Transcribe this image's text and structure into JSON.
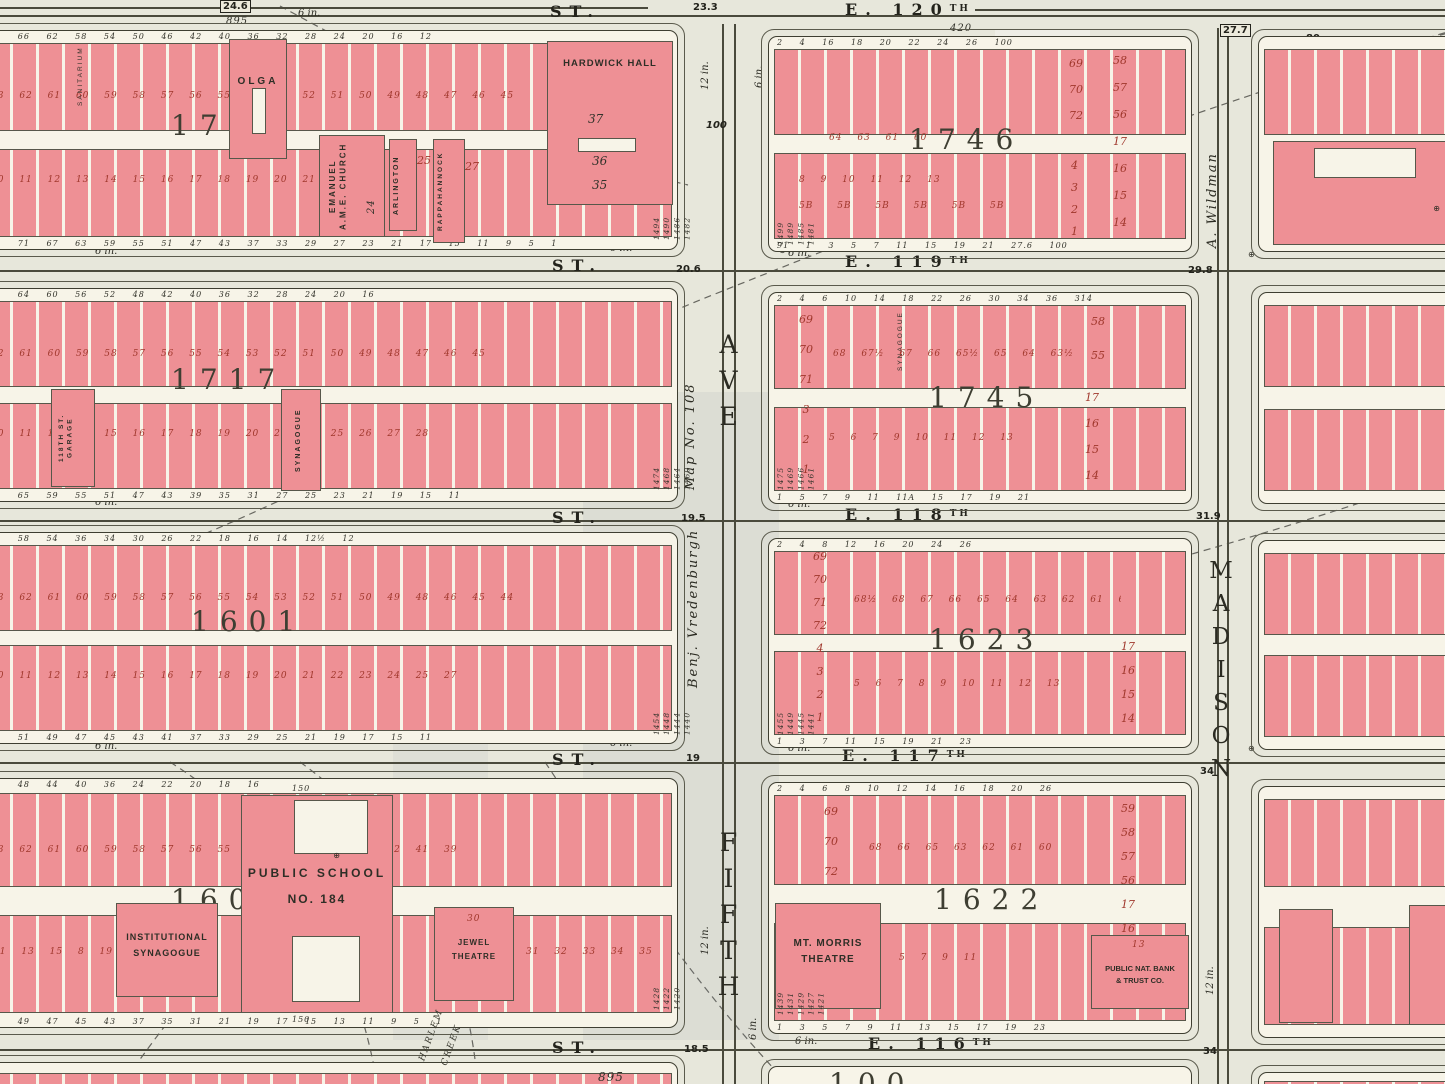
{
  "labels": {
    "st": "ST.",
    "six_in": "6 in.",
    "twelve_in": "12 in.",
    "marker": "⊕"
  },
  "streets": [
    {
      "name": "E. 120",
      "sup": "TH",
      "w1": "24.6",
      "w2": "23.3",
      "w3": "27.7",
      "w4": "80",
      "extra": "895",
      "extra2": "420"
    },
    {
      "name": "E. 119",
      "sup": "TH",
      "w2": "20.6",
      "w3": "29.8"
    },
    {
      "name": "E. 118",
      "sup": "TH",
      "w2": "19.5",
      "w3": "31.9"
    },
    {
      "name": "E. 117",
      "sup": "TH",
      "w2": "19",
      "w3": "34"
    },
    {
      "name": "E. 116",
      "sup": "TH",
      "w2": "18.5",
      "w3": "34"
    }
  ],
  "avenues": {
    "fifth": {
      "ave": "AVE",
      "name": "FIFTH",
      "width": "100",
      "owner1": "Map No. 108",
      "owner2": "Benj. Vredenburgh"
    },
    "madison": {
      "name": "MADISON",
      "owner": "A. Wildman"
    }
  },
  "blocks": {
    "b1718": {
      "number": "1718",
      "dims_top": "70 66 62 58 54 50 46 42 40 36 32 28 24 20 16 12",
      "upper": "63 62 61 60 59 58 57 56 55 54 53 52 51 50 49 48 47 46 45 44",
      "lower": "10 11 12 13 14 15 16 17 18 19 20 21 22",
      "dims_bottom": "75 71 67 63 59 55 51 47 43 37 33 29 27 23 21 17 15 11 9 5 1",
      "sanitarium": "SANITARIUM",
      "olga": "OLGA",
      "church": "EMANUEL\nA.M.E. CHURCH",
      "church_no": "24",
      "arlington": "ARLINGTON",
      "arlington_no": "25",
      "rappa": "RAPPAHANNOCK",
      "rappa_no": "27",
      "hardwick": "HARDWICK HALL",
      "h1": "37",
      "h2": "36",
      "h3": "35"
    },
    "b1746": {
      "number": "1746",
      "dims_top": "2 4 16 18 20 22 24 26 100",
      "left_col": "69\n70\n72",
      "left_col2": "4\n3\n2\n1",
      "right_col": "58\n57\n56\n17\n16\n15\n14",
      "mid": "64 63 61 60",
      "lower": "8 9 10 11 12 13",
      "lower2": "5B 5B 5B 5B 5B 5B",
      "dims_bottom": "91 1 3 5 7 11 15 19 21 27.6 100"
    },
    "bps103": {
      "school1": "PUBLIC SCHOOL",
      "school2": "NO. 103",
      "bldg7": "7",
      "stack": "75\n50\n51\n52",
      "row": "49 48 47 46 45",
      "dims": "21 5 175",
      "houses": "1837\n1835\n1833",
      "top": "52 56 60"
    },
    "b1717": {
      "number": "1717",
      "garage": "118TH ST.\nGARAGE",
      "synagogue": "SYNAGOGUE",
      "dims_top": "68 64 60 56 52 48 42 40 36 32 28 24 20 16",
      "upper": "62 61 60 59 58 57 56 55 54 53 52 51 50 49 48 47 46 45",
      "lower": "10 11 12 14 15 16 17 18 19 20 23 24 25 26 27 28",
      "dims_bottom": "69 65 59 55 51 47 43 39 35 31 27 25 23 21 19 15 11"
    },
    "b1745": {
      "number": "1745",
      "synagogue": "SYNAGOGUE",
      "dims_top": "2 4 6 10 14 18 22 26 30 34 36 314",
      "left_col": "69\n70\n71\n3\n2\n1",
      "upper": "68 67½ 67 66 65½ 65 64 63½ 63 62½ 62 61 60½ 59",
      "lower": "5 6 7 9 10 11 12 13",
      "right_top": "58\n55",
      "right_col": "17\n16\n15\n14",
      "dims_bottom": "1 5 7 9 11 11A 15 17 19 21"
    },
    "b1601": {
      "number": "1601",
      "dims_top": "62 58 54 36 34 30 26 22 18 16 14 12½ 12",
      "upper": "63 62 61 60 59 58 57 56 55 54 53 52 51 50 49 48 46 45 44",
      "lower": "10 11 12 13 14 15 16 17 18 19 20 21 22 23 24 25 27",
      "dims_bottom": "53 51 49 47 45 43 41 37 33 29 25 21 19 17 15 11"
    },
    "b1623": {
      "number": "1623",
      "dims_top": "2 4 8 12 16 20 24 26",
      "left_col": "69\n70\n71\n72\n4\n3\n2\n1",
      "upper": "68½ 68 67 66 65 64 63 62 61 60 59 58 56",
      "lower": "5 6 7 8 9 10 11 12 13",
      "right_col": "17\n16\n15\n14",
      "dims_bottom": "1 3 7 11 15 19 21 23"
    },
    "b1600": {
      "number": "1600",
      "school1": "PUBLIC SCHOOL",
      "school2": "NO. 184",
      "dim150": "150",
      "syn1": "INSTITUTIONAL",
      "syn2": "SYNAGOGUE",
      "jewel1": "JEWEL",
      "jewel2": "THEATRE",
      "jewel_no": "30",
      "dims_top": "52 48 44 40 36 24 22 20 18 16",
      "upper": "63 62 61 60 59 58 57 56 55 54 47 46 45 43 42 41 39 37",
      "lower": "11 13 15 8 19 20",
      "lower2": "31 32 33 34 35",
      "dims_bottom": "51 49 47 45 43 37 35 31 21 19 17 15 13 11 9 5 1"
    },
    "b1622": {
      "number": "1622",
      "th1": "MT. MORRIS",
      "th2": "THEATRE",
      "bank1": "PUBLIC NAT. BANK",
      "bank2": "& TRUST CO.",
      "bank_no": "13",
      "dims_top": "2 4 6 8 10 12 14 16 18 20 26",
      "left_col": "69\n70\n72",
      "upper": "68 66 65 63 62 61 60",
      "lower": "5 7 9 11",
      "right_col": "59\n58\n57\n56\n17\n16",
      "dims_bottom": "1 3 5 7 9 11 13 15 17 19 23"
    },
    "br2": {
      "stack": "50\n51\n52\n53",
      "n20": "20",
      "row": "47 46",
      "lower": "23 24 25 26 27",
      "houses": "1829\n1825\n1821\n1819\n1817\n1815",
      "dims_bottom": "53 51"
    },
    "br3": {
      "stack": "50\n51\n52",
      "row": "49 48 47½ 47 46",
      "stack2": "20\n21\n22",
      "row2": "25 26 27",
      "houses": "1795\n1791\n1787\n1785\n1783",
      "top": "50 52 56 60 25"
    },
    "br4": {
      "stack": "50\n51\n52\n53",
      "row": "49 48 47 46",
      "bevan": "ST. BEVAN",
      "bevan_no": "20",
      "n23": "23",
      "n24": "24",
      "laurel": "LAUREL\nGARDEN",
      "laurel_no": "26",
      "n27": "27",
      "houses": "1781\n1777\n1773\n1771",
      "dims_bottom": "61 69 71 73 75 79 81"
    }
  },
  "fifth_houses": [
    "1494\n1490\n1486\n1482",
    "1499\n1489\n1485\n1481",
    "1474\n1468\n1464\n1460",
    "1475\n1469\n1466\n1461",
    "1454\n1448\n1444\n1440",
    "1455\n1449\n1445\n1441",
    "1428\n1422\n1420",
    "1439\n1431\n1429\n1427\n1421"
  ],
  "bottom": {
    "partial": "100",
    "dim": "895",
    "creek1": "HARLEM",
    "creek2": "CREEK"
  }
}
